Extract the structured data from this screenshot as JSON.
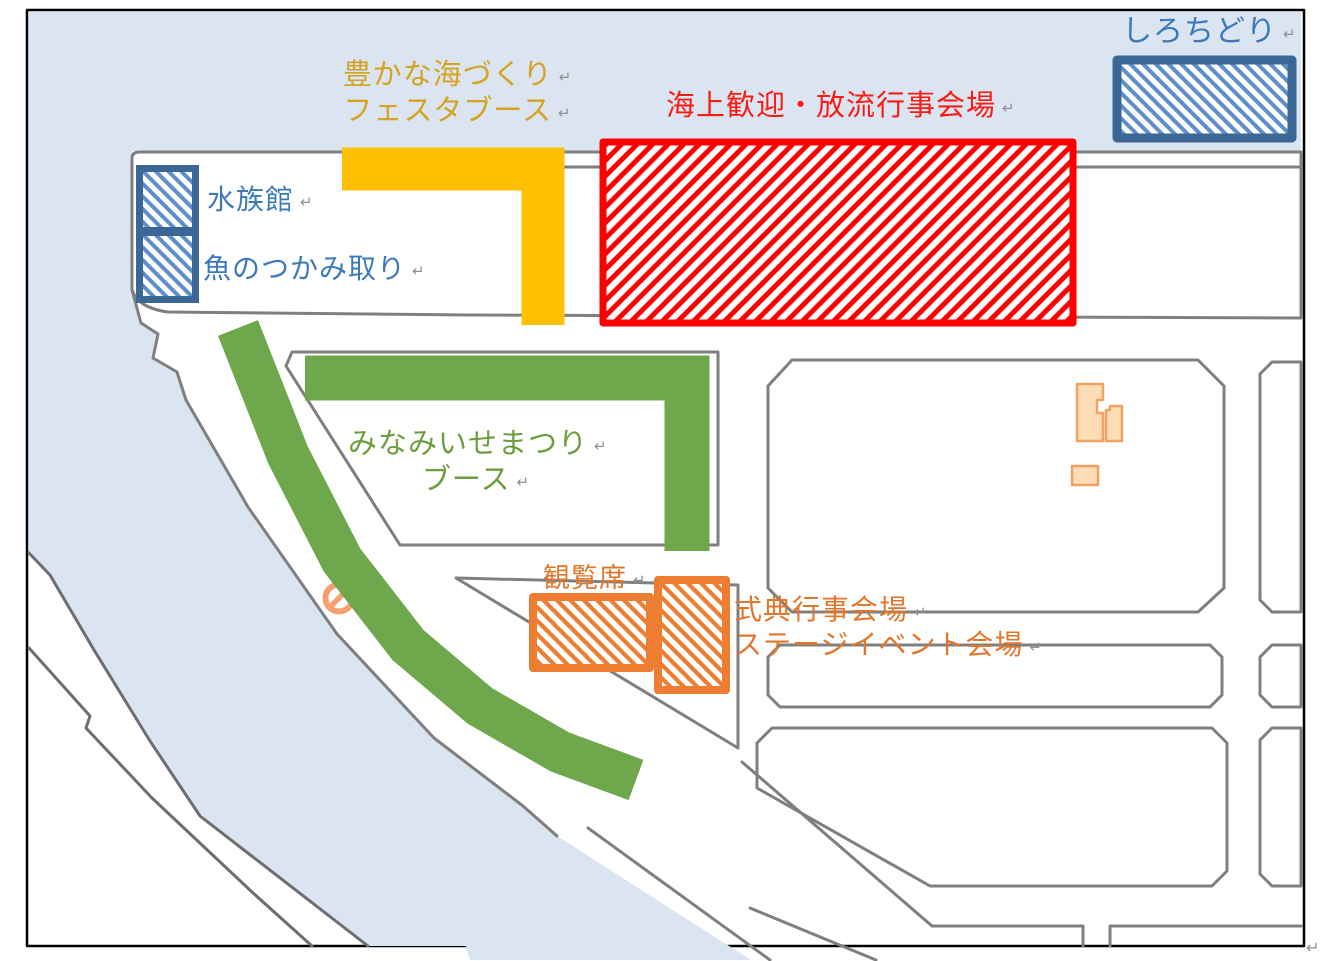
{
  "map": {
    "return_mark": "↵",
    "zones": {
      "shirochidori": {
        "label": "しろちどり",
        "text_color": "#3E7ABF",
        "hatch": "blue-diagonal",
        "border_color": "#3A6795"
      },
      "festa_booth": {
        "label_line1": "豊かな海づくり",
        "label_line2": "フェスタブース",
        "text_color": "#D5A321",
        "band_color": "#FFC000"
      },
      "kaijo_venue": {
        "label": "海上歓迎・放流行事会場",
        "text_color": "#FB1B14",
        "hatch": "red-diagonal",
        "border_color": "#FF0000"
      },
      "aquarium": {
        "label": "水族館",
        "text_color": "#3B79BB",
        "hatch": "blue-diagonal",
        "border_color": "#3A6795"
      },
      "fish_catching": {
        "label": "魚のつかみ取り",
        "text_color": "#3B79BB",
        "hatch": "blue-diagonal",
        "border_color": "#3A6795"
      },
      "minamiise_booth": {
        "label_line1": "みなみいせまつり",
        "label_line2": "ブース",
        "text_color": "#6B9E3E",
        "band_color": "#6FA84C"
      },
      "spectator_seats": {
        "label": "観覧席",
        "text_color": "#E2762B",
        "hatch": "orange-diagonal",
        "border_color": "#ED7D31"
      },
      "ceremony_venue": {
        "label_line1": "式典行事会場",
        "label_line2": "ステージイベント会場",
        "text_color": "#E2762B",
        "hatch": "orange-diagonal",
        "border_color": "#ED7D31"
      }
    },
    "palette": {
      "sea_water": "#DBE5F1",
      "land": "#FFFFFF",
      "parcel_outline": "#7F7F7F",
      "image_frame": "#000000",
      "building_fill": "#FCDDB5",
      "building_stroke": "#F1A263",
      "no_entry_icon": "#F2894D",
      "red_hatch": "#FF0000",
      "yellow_band": "#FFC000",
      "green_band": "#6FA84C",
      "orange_hatch": "#ED7D31",
      "blue_hatch_stripe": "#5E8FC6",
      "blue_hatch_border": "#3A6795"
    }
  }
}
